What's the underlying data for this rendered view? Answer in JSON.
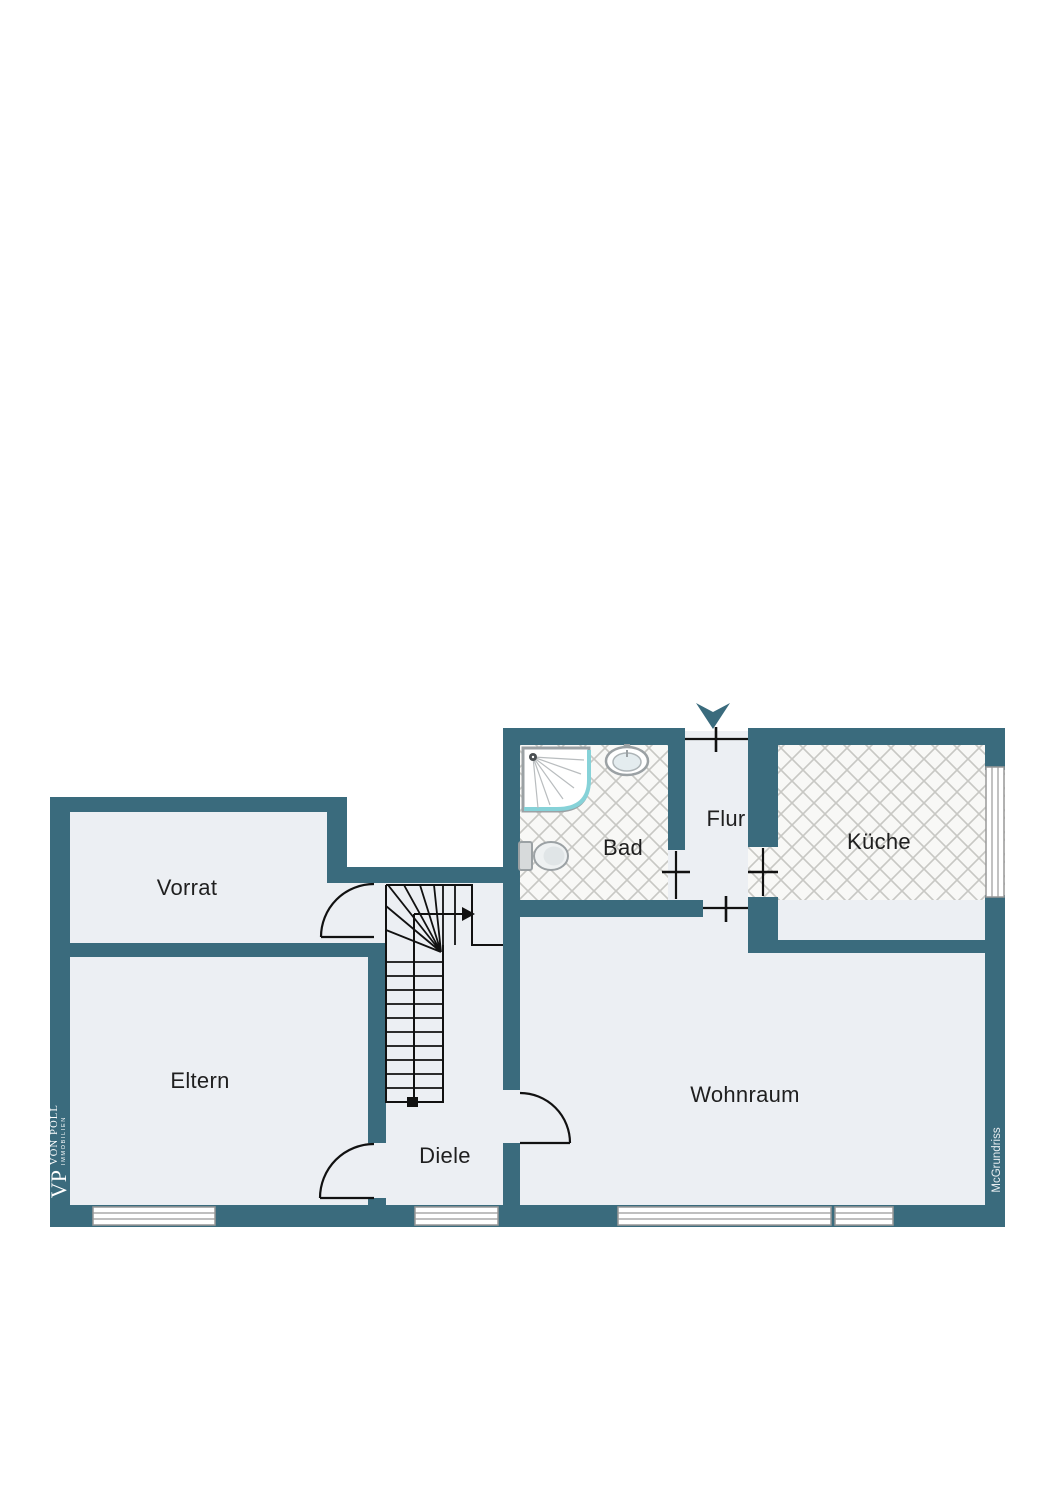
{
  "page": {
    "background": "#ffffff",
    "type": "floor-plan"
  },
  "branding": {
    "logo_vp": "VP",
    "logo_name": "VON POLL",
    "logo_sub": "IMMOBILIEN",
    "watermark": "McGrundriss"
  },
  "rooms": {
    "vorrat": "Vorrat",
    "eltern": "Eltern",
    "diele": "Diele",
    "bad": "Bad",
    "flur": "Flur",
    "kueche": "Küche",
    "wohnraum": "Wohnraum"
  },
  "icons": [
    "entrance-arrow-icon",
    "stairs-icon",
    "shower-icon",
    "sink-icon",
    "toilet-icon",
    "door-arc-icon",
    "window-icon"
  ],
  "colors": {
    "wall": "#3a6b7d",
    "floor": "#eceff3",
    "tile_bg": "#f8f8f6",
    "tile_line": "#c8c8c4",
    "outline": "#111111",
    "fixture": "#9ba1a4",
    "glass": "#86d2d8",
    "window_frame": "#999999",
    "label_text": "#1f1f1f",
    "logo_text": "#ffffff"
  }
}
